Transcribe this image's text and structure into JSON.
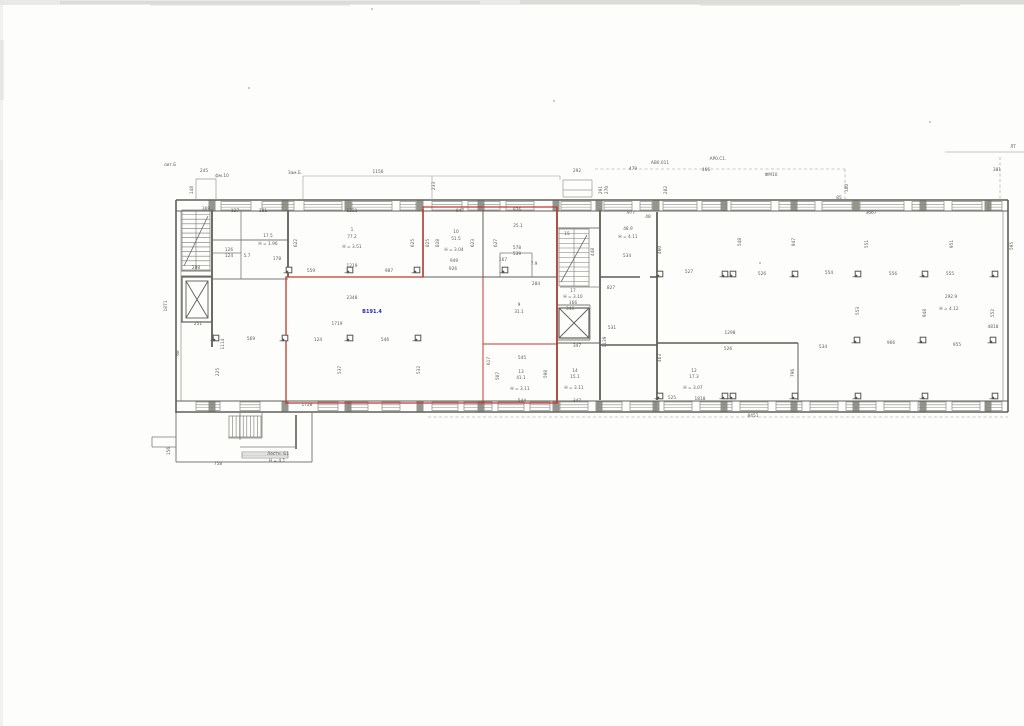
{
  "document": {
    "kind": "scanned-floor-plan",
    "page_marker": "ЛТ",
    "unit_area_label": "В191.4",
    "stair_annotation": [
      "Лестн. Б1",
      "Н = 4,1"
    ]
  },
  "colors": {
    "paper": "#fdfdfc",
    "wall": "#5e5e58",
    "thin": "#7b7b74",
    "dim": "#9a9a93",
    "label": "#5c5c55",
    "red": "#c23a2c",
    "blue": "#2a28bd",
    "noise": "#d8d8d5"
  },
  "scan": {
    "specks": [
      [
        249,
        88
      ],
      [
        554,
        101
      ],
      [
        760,
        263
      ],
      [
        930,
        122
      ],
      [
        372,
        9
      ]
    ]
  },
  "plan": {
    "walls": [
      [
        176,
        200,
        1008,
        200,
        1.4,
        0
      ],
      [
        176,
        211,
        1008,
        211,
        1.1,
        0
      ],
      [
        176,
        401,
        1008,
        401,
        1.1,
        0
      ],
      [
        176,
        412,
        1008,
        412,
        1.4,
        0
      ],
      [
        176,
        200,
        176,
        413,
        1.6,
        0
      ],
      [
        1008,
        200,
        1008,
        412,
        1.6,
        0
      ],
      [
        181,
        211,
        181,
        401,
        0.6,
        1
      ],
      [
        1003,
        211,
        1003,
        401,
        0.6,
        1
      ],
      [
        196,
        179,
        216,
        179,
        0.7,
        2
      ],
      [
        196,
        179,
        196,
        200,
        0.7,
        2
      ],
      [
        216,
        179,
        216,
        200,
        0.7,
        2
      ],
      [
        563,
        180,
        592,
        180,
        0.7,
        2
      ],
      [
        563,
        197,
        592,
        197,
        0.7,
        2
      ],
      [
        563,
        180,
        563,
        197,
        0.7,
        2
      ],
      [
        592,
        180,
        592,
        197,
        0.7,
        2
      ],
      [
        563,
        190,
        592,
        190,
        0.7,
        2
      ],
      [
        303,
        176,
        560,
        176,
        0.6,
        2
      ],
      [
        303,
        176,
        303,
        200,
        0.6,
        2
      ],
      [
        432,
        176,
        432,
        200,
        0.6,
        2
      ],
      [
        560,
        176,
        560,
        180,
        0.6,
        2
      ],
      [
        212,
        209,
        212,
        347,
        1.8,
        0
      ],
      [
        181,
        271,
        211,
        271,
        1.0,
        1
      ],
      [
        181,
        276,
        212,
        276,
        1.0,
        1
      ],
      [
        181,
        322,
        212,
        322,
        1.0,
        1
      ],
      [
        212,
        240,
        288,
        240,
        1.0,
        1
      ],
      [
        241,
        209,
        241,
        240,
        0.8,
        1
      ],
      [
        241,
        240,
        241,
        279,
        0.8,
        1
      ],
      [
        212,
        253,
        241,
        253,
        0.8,
        1
      ],
      [
        212,
        279,
        288,
        279,
        1.0,
        1
      ],
      [
        288,
        209,
        288,
        277,
        1.8,
        0
      ],
      [
        288,
        277,
        557,
        277,
        1.0,
        0
      ],
      [
        423,
        209,
        423,
        277,
        1.5,
        0
      ],
      [
        483,
        209,
        483,
        277,
        1.0,
        0
      ],
      [
        500,
        253,
        532,
        253,
        0.8,
        1
      ],
      [
        500,
        253,
        500,
        277,
        0.8,
        1
      ],
      [
        532,
        253,
        532,
        277,
        0.8,
        1
      ],
      [
        557,
        207,
        557,
        403,
        1.8,
        0
      ],
      [
        600,
        209,
        600,
        400,
        1.8,
        0
      ],
      [
        483,
        277,
        483,
        403,
        1.0,
        0
      ],
      [
        483,
        344,
        557,
        344,
        1.0,
        0
      ],
      [
        557,
        343,
        600,
        343,
        1.0,
        0
      ],
      [
        557,
        228,
        600,
        228,
        1.0,
        1
      ],
      [
        560,
        287,
        600,
        287,
        0.8,
        1
      ],
      [
        557,
        305,
        590,
        305,
        1.0,
        1
      ],
      [
        590,
        305,
        590,
        340,
        0.8,
        1
      ],
      [
        557,
        340,
        590,
        340,
        1.0,
        1
      ],
      [
        600,
        277,
        640,
        277,
        1.6,
        0
      ],
      [
        650,
        277,
        657,
        277,
        1.6,
        0
      ],
      [
        600,
        345,
        657,
        345,
        1.6,
        0
      ],
      [
        657,
        212,
        657,
        400,
        1.8,
        0
      ],
      [
        657,
        343,
        798,
        343,
        1.6,
        0
      ],
      [
        798,
        343,
        798,
        400,
        1.0,
        0
      ],
      [
        176,
        413,
        176,
        462,
        1.0,
        1
      ],
      [
        176,
        462,
        312,
        462,
        1.0,
        1
      ],
      [
        312,
        413,
        312,
        462,
        1.0,
        1
      ],
      [
        240,
        413,
        240,
        440,
        0.8,
        1
      ],
      [
        296,
        415,
        296,
        449,
        1.6,
        0
      ],
      [
        240,
        447,
        296,
        447,
        0.8,
        1
      ],
      [
        152,
        437,
        176,
        437,
        0.8,
        1
      ],
      [
        152,
        437,
        152,
        447,
        0.8,
        1
      ],
      [
        152,
        447,
        176,
        447,
        0.8,
        1
      ],
      [
        228,
        438,
        262,
        438,
        0.8,
        1
      ],
      [
        262,
        413,
        262,
        438,
        0.8,
        1
      ]
    ],
    "dashed": [
      [
        595,
        169,
        845,
        169
      ],
      [
        845,
        169,
        845,
        199
      ],
      [
        428,
        417,
        1008,
        417
      ],
      [
        1000,
        157,
        1000,
        199
      ]
    ],
    "faint_lines": [
      [
        945,
        152,
        1024,
        152
      ]
    ],
    "red_polygon": "423,207 557,207 557,403 286,403 286,277 423,277",
    "red_lines": [
      [
        483,
        277,
        483,
        403
      ],
      [
        483,
        344,
        557,
        344
      ]
    ],
    "windows": [
      [
        221,
        201.5,
        30
      ],
      [
        262,
        201.5,
        32
      ],
      [
        304,
        201.5,
        38
      ],
      [
        352,
        201.5,
        40
      ],
      [
        400,
        201.5,
        16
      ],
      [
        432,
        201.5,
        30
      ],
      [
        468,
        201.5,
        32
      ],
      [
        506,
        201.5,
        28
      ],
      [
        561,
        201.5,
        30
      ],
      [
        604,
        201.5,
        28
      ],
      [
        640,
        201.5,
        12
      ],
      [
        663,
        201.5,
        34
      ],
      [
        702,
        201.5,
        24
      ],
      [
        731,
        201.5,
        40
      ],
      [
        779,
        201.5,
        36
      ],
      [
        822,
        201.5,
        30
      ],
      [
        860,
        201.5,
        44
      ],
      [
        912,
        201.5,
        32
      ],
      [
        952,
        201.5,
        30
      ],
      [
        988,
        201.5,
        14
      ],
      [
        432,
        402,
        26
      ],
      [
        464,
        402,
        28
      ],
      [
        498,
        402,
        26
      ],
      [
        530,
        402,
        20
      ],
      [
        560,
        402,
        28
      ],
      [
        598,
        402,
        24
      ],
      [
        630,
        402,
        26
      ],
      [
        664,
        402,
        28
      ],
      [
        700,
        402,
        32
      ],
      [
        740,
        402,
        28
      ],
      [
        776,
        402,
        26
      ],
      [
        810,
        402,
        28
      ],
      [
        846,
        402,
        30
      ],
      [
        884,
        402,
        26
      ],
      [
        918,
        402,
        28
      ],
      [
        952,
        402,
        28
      ],
      [
        986,
        402,
        16
      ],
      [
        196,
        402,
        24
      ],
      [
        240,
        402,
        20
      ],
      [
        318,
        402,
        20
      ],
      [
        348,
        402,
        20
      ],
      [
        382,
        402,
        18
      ],
      [
        242,
        452,
        46,
        6
      ]
    ],
    "piers": {
      "xs": [
        212,
        285,
        348,
        420,
        481,
        556,
        599,
        656,
        724,
        794,
        856,
        923,
        988
      ],
      "top_y": 200.5,
      "bottom_y": 401.5
    },
    "columns": [
      [
        289,
        270
      ],
      [
        350,
        270
      ],
      [
        417,
        270
      ],
      [
        505,
        270
      ],
      [
        216,
        338
      ],
      [
        285,
        338
      ],
      [
        350,
        338
      ],
      [
        418,
        338
      ],
      [
        660,
        274
      ],
      [
        725,
        274,
        1
      ],
      [
        795,
        274
      ],
      [
        858,
        274
      ],
      [
        925,
        274
      ],
      [
        995,
        274
      ],
      [
        857,
        340
      ],
      [
        923,
        340
      ],
      [
        993,
        340
      ],
      [
        660,
        396
      ],
      [
        725,
        396,
        1
      ],
      [
        795,
        396
      ],
      [
        858,
        396
      ],
      [
        925,
        396
      ],
      [
        995,
        396
      ]
    ],
    "stairs": [
      {
        "x": 182,
        "y": 210,
        "w": 28,
        "h": 60,
        "dir": "h",
        "n": 13,
        "diag": true
      },
      {
        "x": 559,
        "y": 229,
        "w": 30,
        "h": 57,
        "dir": "h",
        "n": 12,
        "diag": true
      },
      {
        "x": 229,
        "y": 416,
        "w": 32,
        "h": 21,
        "dir": "v",
        "n": 9
      }
    ],
    "elevators": [
      {
        "x": 182,
        "y": 277,
        "w": 30,
        "h": 45,
        "inner": true
      },
      {
        "x": 559,
        "y": 308,
        "w": 30,
        "h": 30,
        "inner": false
      }
    ],
    "labels": [
      [
        "лит.Б",
        170,
        166
      ],
      [
        "245",
        204,
        172
      ],
      [
        "фм.10",
        222,
        177
      ],
      [
        "148",
        193,
        190,
        1
      ],
      [
        "Зам.Б.",
        295,
        174
      ],
      [
        "1156",
        378,
        173
      ],
      [
        "233",
        435,
        186,
        1
      ],
      [
        "292",
        577,
        172
      ],
      [
        "291",
        602,
        190,
        1
      ],
      [
        "270",
        608,
        190,
        1
      ],
      [
        "479",
        633,
        170
      ],
      [
        "АВ0.011",
        660,
        164
      ],
      [
        "466",
        706,
        171
      ],
      [
        "АР0.С1.",
        718,
        160
      ],
      [
        "ФМ10",
        771,
        176
      ],
      [
        "282",
        667,
        190,
        1
      ],
      [
        "180",
        848,
        188,
        1
      ],
      [
        "85",
        839,
        199
      ],
      [
        "ЛТ",
        1013,
        148
      ],
      [
        "381",
        997,
        171
      ],
      [
        "369",
        206,
        210
      ],
      [
        "127",
        235,
        212
      ],
      [
        "381",
        263,
        212
      ],
      [
        "1221",
        352,
        212
      ],
      [
        "947",
        460,
        212
      ],
      [
        "976",
        517,
        211
      ],
      [
        "977",
        631,
        214
      ],
      [
        "3667",
        871,
        214
      ],
      [
        "288",
        196,
        269
      ],
      [
        "251",
        198,
        325
      ],
      [
        "1871",
        167,
        306,
        1
      ],
      [
        "17.5",
        268,
        237
      ],
      [
        "Н = 1.96",
        268,
        245
      ],
      [
        "5.7",
        247,
        257
      ],
      [
        "126",
        229,
        251
      ],
      [
        "124",
        229,
        257
      ],
      [
        "178",
        277,
        260
      ],
      [
        "1",
        352,
        231
      ],
      [
        "77.2",
        352,
        238
      ],
      [
        "Н = 3.51",
        352,
        248
      ],
      [
        "559",
        311,
        272
      ],
      [
        "1219",
        352,
        267
      ],
      [
        "987",
        389,
        272
      ],
      [
        "622",
        297,
        243,
        1
      ],
      [
        "625",
        414,
        243,
        1
      ],
      [
        "825",
        429,
        243,
        1
      ],
      [
        "2348",
        352,
        299
      ],
      [
        "1719",
        337,
        325
      ],
      [
        "569",
        251,
        340
      ],
      [
        "124",
        318,
        341
      ],
      [
        "546",
        385,
        341
      ],
      [
        "1114",
        224,
        344,
        1
      ],
      [
        "225",
        219,
        372,
        1
      ],
      [
        "537",
        341,
        370,
        1
      ],
      [
        "532",
        420,
        370,
        1
      ],
      [
        "68",
        179,
        353,
        1
      ],
      [
        "1728",
        307,
        406
      ],
      [
        "10",
        456,
        233
      ],
      [
        "51.5",
        456,
        240
      ],
      [
        "Н = 3.04",
        454,
        251
      ],
      [
        "949",
        454,
        262
      ],
      [
        "926",
        453,
        270
      ],
      [
        "828",
        439,
        243,
        1
      ],
      [
        "623",
        474,
        243,
        1
      ],
      [
        "627",
        497,
        243,
        1
      ],
      [
        "25.1",
        518,
        227
      ],
      [
        "578",
        517,
        249
      ],
      [
        "539",
        517,
        255
      ],
      [
        "167",
        503,
        261
      ],
      [
        "7.9",
        534,
        265
      ],
      [
        "284",
        536,
        285
      ],
      [
        "9",
        519,
        306
      ],
      [
        "31.1",
        519,
        313
      ],
      [
        "545",
        522,
        359
      ],
      [
        "13",
        521,
        373
      ],
      [
        "41.1",
        521,
        379
      ],
      [
        "Н = 3.11",
        520,
        390
      ],
      [
        "544",
        522,
        402
      ],
      [
        "617",
        490,
        361,
        1
      ],
      [
        "507",
        499,
        376,
        1
      ],
      [
        "598",
        547,
        374,
        1
      ],
      [
        "14",
        575,
        372
      ],
      [
        "15.1",
        575,
        378
      ],
      [
        "Н = 3.11",
        574,
        389
      ],
      [
        "347",
        577,
        347
      ],
      [
        "347",
        577,
        402
      ],
      [
        "15",
        567,
        235
      ],
      [
        "448",
        594,
        252,
        1
      ],
      [
        "17",
        573,
        292
      ],
      [
        "Н = 3.10",
        573,
        298
      ],
      [
        "166",
        573,
        304
      ],
      [
        "346",
        570,
        310
      ],
      [
        "48.9",
        628,
        230
      ],
      [
        "Н = 4.11",
        628,
        238
      ],
      [
        "534",
        627,
        257
      ],
      [
        "827",
        611,
        289
      ],
      [
        "531",
        612,
        329
      ],
      [
        "1139",
        606,
        342,
        1
      ],
      [
        "460",
        661,
        250,
        1
      ],
      [
        "463",
        661,
        358,
        1
      ],
      [
        "48",
        648,
        218
      ],
      [
        "527",
        689,
        273
      ],
      [
        "526",
        762,
        275
      ],
      [
        "554",
        829,
        274
      ],
      [
        "556",
        893,
        275
      ],
      [
        "555",
        950,
        275
      ],
      [
        "548",
        741,
        242,
        1
      ],
      [
        "947",
        795,
        242,
        1
      ],
      [
        "551",
        868,
        244,
        1
      ],
      [
        "951",
        953,
        244,
        1
      ],
      [
        "595",
        1013,
        246,
        1
      ],
      [
        "292.9",
        951,
        298
      ],
      [
        "Н = 4.12",
        949,
        310
      ],
      [
        "4818",
        993,
        328
      ],
      [
        "1298",
        730,
        334
      ],
      [
        "526",
        728,
        350
      ],
      [
        "534",
        823,
        348
      ],
      [
        "966",
        891,
        344
      ],
      [
        "955",
        957,
        346
      ],
      [
        "553",
        859,
        311,
        1
      ],
      [
        "948",
        926,
        313,
        1
      ],
      [
        "552",
        994,
        313,
        1
      ],
      [
        "12",
        694,
        372
      ],
      [
        "17.3",
        694,
        378
      ],
      [
        "Н = 3.07",
        693,
        389
      ],
      [
        "796",
        794,
        373,
        1
      ],
      [
        "525",
        672,
        399
      ],
      [
        "1818",
        700,
        400
      ],
      [
        "8451",
        753,
        417
      ],
      [
        "758",
        218,
        465
      ],
      [
        "156",
        170,
        451,
        1
      ],
      [
        "Лестн. Б1",
        278,
        455
      ],
      [
        "Н = 4,1",
        277,
        462
      ],
      [
        "В191.4",
        372,
        313,
        0,
        "#2a28bd",
        5,
        1
      ]
    ]
  }
}
